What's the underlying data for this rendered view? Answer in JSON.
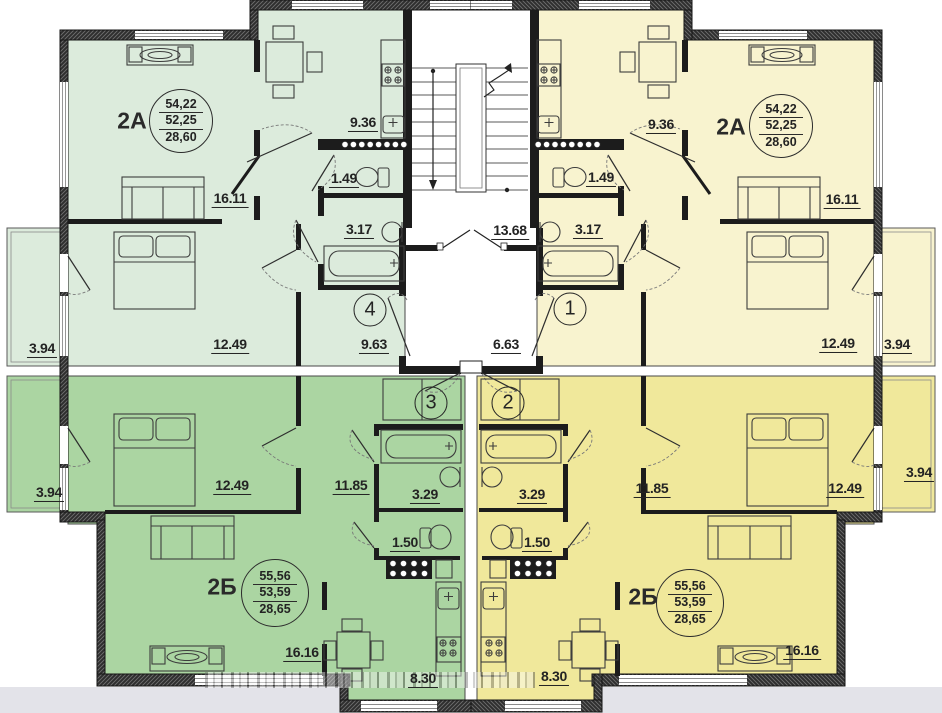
{
  "colors": {
    "apartment_top_left": "#dcebdc",
    "apartment_top_right": "#f8f3cf",
    "apartment_bottom_left": "#abd5a2",
    "apartment_bottom_right": "#f0e89b",
    "wall": "#1c1c1c",
    "outside_background": "#e3e3e9"
  },
  "apartments": {
    "top_left": {
      "code": "2А",
      "areas": {
        "total": "54,22",
        "living": "52,25",
        "kitchen": "28,60"
      },
      "dims": {
        "living": "16.11",
        "bedroom": "12.49",
        "balcony": "3.94",
        "kitchen": "9.36",
        "wc": "1.49",
        "bath": "3.17",
        "hall": "9.63"
      }
    },
    "top_right": {
      "code": "2А",
      "areas": {
        "total": "54,22",
        "living": "52,25",
        "kitchen": "28,60"
      },
      "dims": {
        "living": "16.11",
        "bedroom": "12.49",
        "balcony": "3.94",
        "kitchen": "9.36",
        "wc": "1.49",
        "bath": "3.17",
        "hall": "6.63"
      }
    },
    "bottom_left": {
      "code": "2Б",
      "areas": {
        "total": "55,56",
        "living": "53,59",
        "kitchen": "28,65"
      },
      "dims": {
        "living": "16.16",
        "bedroom": "12.49",
        "balcony": "3.94",
        "kitchen": "8.30",
        "wc": "1.50",
        "bath": "3.29",
        "hall": "11.85"
      }
    },
    "bottom_right": {
      "code": "2Б",
      "areas": {
        "total": "55,56",
        "living": "53,59",
        "kitchen": "28,65"
      },
      "dims": {
        "living": "16.16",
        "bedroom": "12.49",
        "balcony": "3.94",
        "kitchen": "8.30",
        "wc": "1.50",
        "bath": "3.29",
        "hall": "11.85"
      }
    }
  },
  "stairwell": {
    "landing": "13.68"
  },
  "units": {
    "unit_1": "1",
    "unit_2": "2",
    "unit_3": "3",
    "unit_4": "4"
  }
}
